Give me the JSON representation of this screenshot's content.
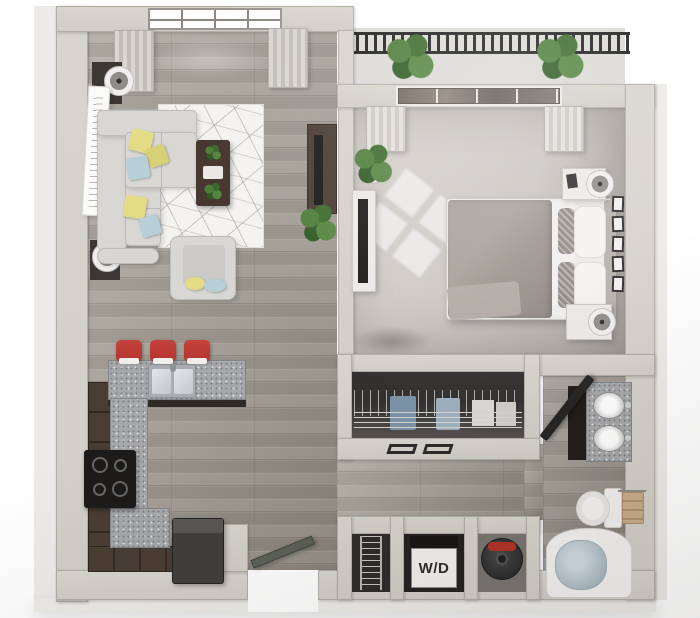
{
  "title": "3D one-bedroom apartment floor plan",
  "labels": {
    "washer_dryer": "W/D"
  },
  "colors": {
    "wall_top": "#d8d5ce",
    "wall_face": "#edebe7",
    "wood_floor": "#a7a199",
    "carpet": "#c9c5bf",
    "cabinet_brown": "#4a3d33",
    "granite": "#a6a7a9",
    "sofa_gray": "#d8d7d4",
    "pillow_yellow": "#e3dc85",
    "pillow_blue": "#b6cfd8",
    "stool_red": "#b23530",
    "table_brown": "#463830",
    "plant_green": "#4e7d3a",
    "railing_black": "#1f1f1f",
    "bed_gray": "#9c958e",
    "water_blue": "#b3c2cb",
    "heater_red": "#b23327",
    "door_dark": "#262522",
    "door_green": "#5c6157",
    "appliance_dark": "#232221"
  },
  "rooms": {
    "living_room": {
      "furniture": [
        "sectional-sofa",
        "armchair",
        "area-rug",
        "coffee-table",
        "tv-console",
        "floor-lamps",
        "wall-art",
        "plants",
        "window-curtains"
      ]
    },
    "bedroom": {
      "furniture": [
        "bed",
        "nightstands",
        "table-lamps",
        "tv-console",
        "picture-frames",
        "plant",
        "window-curtains"
      ]
    },
    "kitchen": {
      "furniture": [
        "l-shaped-counter",
        "peninsula-with-sink",
        "bar-stools",
        "cooktop",
        "refrigerator"
      ]
    },
    "closet": {
      "furniture": [
        "hanging-rod",
        "wire-shelf",
        "sliding-doors"
      ]
    },
    "bathroom": {
      "furniture": [
        "double-sink-vanity",
        "toilet",
        "towel-bar",
        "bathtub"
      ]
    },
    "utility": {
      "furniture": [
        "wire-shelving",
        "washer-dryer",
        "water-heater"
      ]
    },
    "balcony": {
      "furniture": [
        "railing",
        "plants"
      ]
    }
  }
}
